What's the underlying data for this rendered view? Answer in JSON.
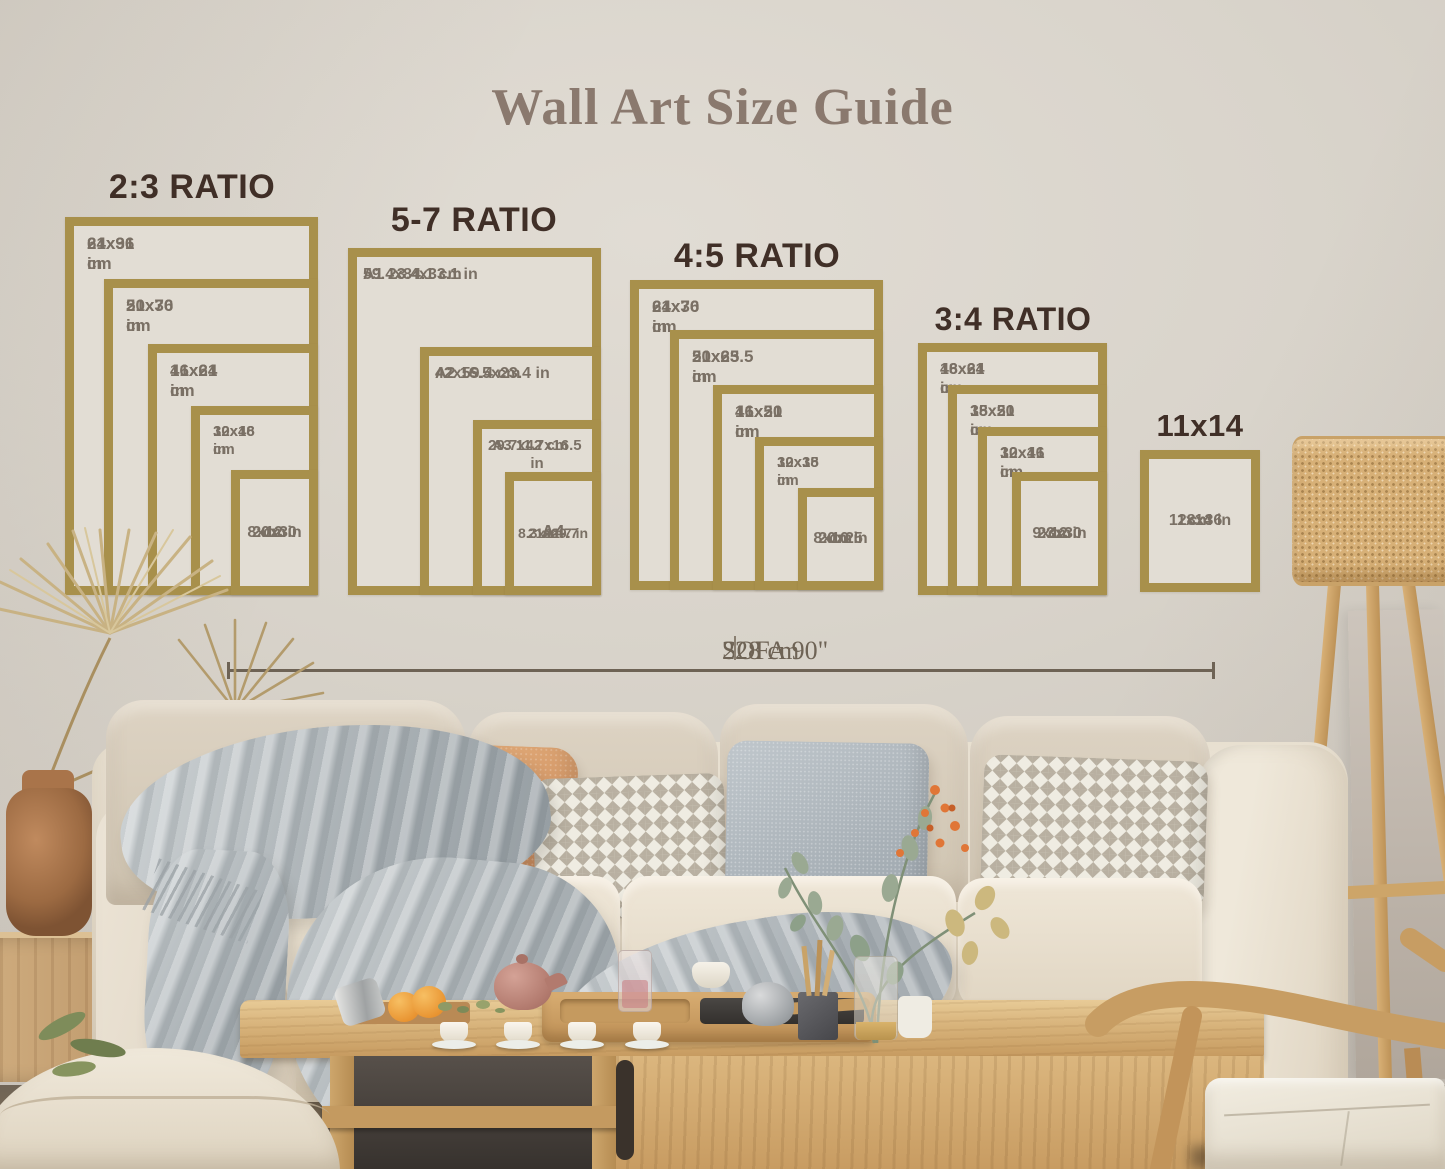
{
  "title": "Wall Art Size Guide",
  "groups": [
    {
      "title": "2:3 RATIO",
      "frames": [
        {
          "lines": [
            "24x36 in",
            "61x91 cm"
          ]
        },
        {
          "lines": [
            "20x30 in",
            "51x76 cm"
          ]
        },
        {
          "lines": [
            "16x24 in",
            "41x61 cm"
          ]
        },
        {
          "lines": [
            "12x18 in",
            "30x46 cm"
          ]
        },
        {
          "lines": [
            "8x12 in",
            "20x30",
            "cm"
          ]
        }
      ]
    },
    {
      "title": "5-7 RATIO",
      "frames": [
        {
          "lines": [
            "A1 23.4x33.1 in",
            "59.4x84.1 cm"
          ]
        },
        {
          "lines": [
            "A2 16.5x23.4 in",
            "42x59.4 cm"
          ]
        },
        {
          "lines": [
            "A3 11.7x16.5 in",
            "29.7x42 cm"
          ]
        },
        {
          "lines": [
            "A4",
            "8.3x11.7 in",
            "21x29.7",
            "cm"
          ]
        }
      ]
    },
    {
      "title": "4:5 RATIO",
      "frames": [
        {
          "lines": [
            "24x30 in",
            "61x76 cm"
          ]
        },
        {
          "lines": [
            "20x25 in",
            "51x63.5 cm"
          ]
        },
        {
          "lines": [
            "16x20 in",
            "41x51 cm"
          ]
        },
        {
          "lines": [
            "12x15 in",
            "30x38 cm"
          ]
        },
        {
          "lines": [
            "8x10 in",
            "20x25",
            "cm"
          ]
        }
      ]
    },
    {
      "title": "3:4 RATIO",
      "frames": [
        {
          "lines": [
            "18x24 in",
            "46x61 cm"
          ]
        },
        {
          "lines": [
            "15x20 in",
            "38x51 cm"
          ]
        },
        {
          "lines": [
            "12x16 in",
            "30x41 cm"
          ]
        },
        {
          "lines": [
            "9x12 in",
            "23x30",
            "cm"
          ]
        }
      ]
    },
    {
      "title": "11x14",
      "frames": [
        {
          "lines": [
            "11x14 in",
            "28x36",
            "cm"
          ]
        }
      ]
    }
  ],
  "measurement": {
    "label_left": "SOFA 90\"",
    "label_right": "228 cm"
  },
  "colors": {
    "frame_gold": "#a8904b",
    "frame_interior": "#e2ddd4",
    "wall": "#d9d4cb",
    "ratio_title": "#402f27",
    "main_title": "#8a796e",
    "frame_label": "#7a7065",
    "measurement": "#6e6355"
  }
}
